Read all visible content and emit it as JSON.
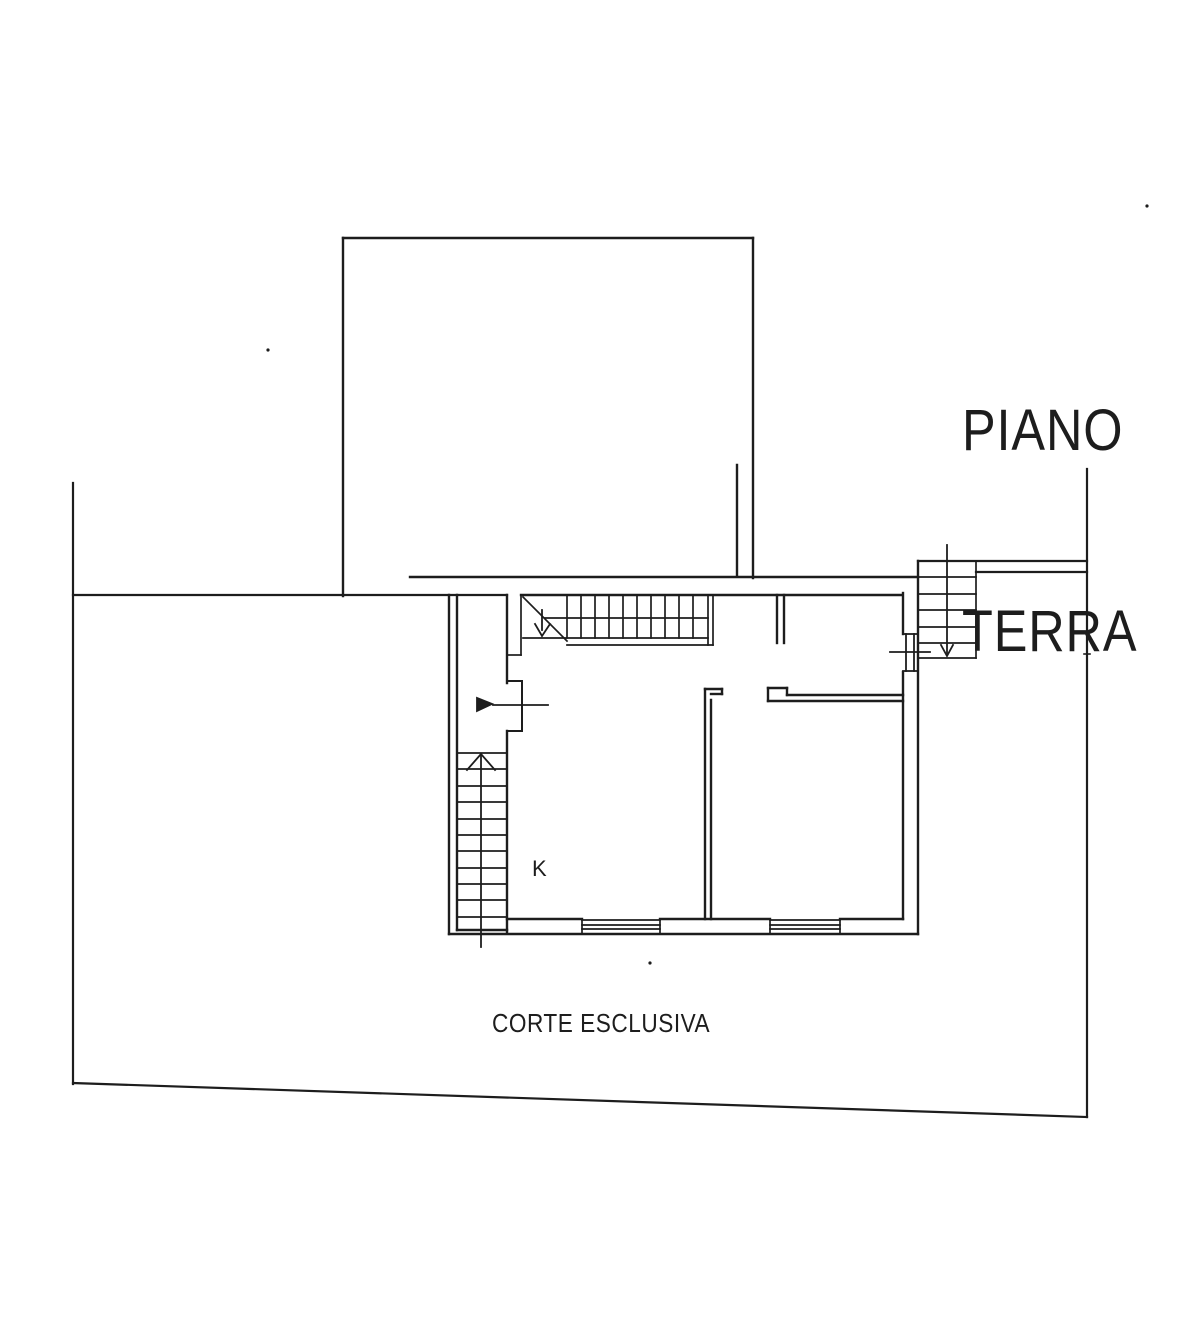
{
  "page": {
    "width": 1204,
    "height": 1328,
    "background": "#ffffff",
    "ink": "#1d1d1d"
  },
  "title": {
    "line1": "PIANO",
    "line2": "TERRA"
  },
  "plan_labels": {
    "kitchen": "K",
    "courtyard": "CORTE ESCLUSIVA"
  },
  "drawing": {
    "groups": [
      {
        "name": "property-boundary",
        "stroke_width": 2.2,
        "lines": [
          [
            73,
            483,
            73,
            1084
          ],
          [
            73,
            1083,
            1087,
            1117
          ],
          [
            1087,
            469,
            1087,
            1117
          ],
          [
            73,
            595,
            507,
            595
          ],
          [
            918,
            561,
            1087,
            561
          ],
          [
            976,
            572,
            1087,
            572
          ]
        ]
      },
      {
        "name": "upper-building",
        "stroke_width": 2.4,
        "lines": [
          [
            343,
            238,
            343,
            596
          ],
          [
            343,
            238,
            753,
            238
          ],
          [
            753,
            238,
            753,
            578
          ],
          [
            410,
            577,
            918,
            577
          ],
          [
            737,
            465,
            737,
            576
          ]
        ]
      },
      {
        "name": "main-building-walls",
        "stroke_width": 2.4,
        "lines": [
          [
            449,
            595,
            449,
            934
          ],
          [
            457,
            595,
            457,
            930
          ],
          [
            521,
            595,
            902,
            595
          ],
          [
            507,
            595,
            507,
            683
          ],
          [
            507,
            731,
            507,
            933
          ],
          [
            449,
            934,
            918,
            934
          ],
          [
            457,
            930,
            507,
            930
          ],
          [
            507,
            919,
            582,
            919
          ],
          [
            660,
            919,
            770,
            919
          ],
          [
            840,
            919,
            903,
            919
          ],
          [
            903,
            593,
            903,
            634
          ],
          [
            903,
            672,
            903,
            919
          ],
          [
            918,
            561,
            918,
            934
          ],
          [
            705,
            689,
            705,
            919
          ],
          [
            711,
            700,
            711,
            919
          ],
          [
            705,
            689,
            722,
            689
          ],
          [
            711,
            694,
            722,
            694
          ],
          [
            722,
            689,
            722,
            694
          ],
          [
            768,
            688,
            787,
            688
          ],
          [
            768,
            688,
            768,
            701
          ],
          [
            787,
            688,
            787,
            695
          ],
          [
            787,
            695,
            903,
            695
          ],
          [
            768,
            701,
            903,
            701
          ],
          [
            777,
            595,
            777,
            643
          ],
          [
            784,
            595,
            784,
            643
          ]
        ]
      },
      {
        "name": "entry-door-recess",
        "stroke_width": 2,
        "lines": [
          [
            507,
            681,
            522,
            681
          ],
          [
            507,
            731,
            522,
            731
          ],
          [
            522,
            681,
            522,
            731
          ]
        ]
      },
      {
        "name": "window-symbols",
        "stroke_width": 1.7,
        "lines": [
          [
            582,
            920,
            660,
            920
          ],
          [
            582,
            925,
            660,
            925
          ],
          [
            582,
            929,
            660,
            929
          ],
          [
            582,
            920,
            582,
            933
          ],
          [
            660,
            920,
            660,
            933
          ],
          [
            770,
            920,
            840,
            920
          ],
          [
            770,
            925,
            840,
            925
          ],
          [
            770,
            929,
            840,
            929
          ],
          [
            770,
            920,
            770,
            933
          ],
          [
            840,
            920,
            840,
            933
          ]
        ]
      },
      {
        "name": "entry-door-symbol",
        "stroke_width": 1.8,
        "lines": [
          [
            903,
            634,
            917,
            634
          ],
          [
            903,
            671,
            917,
            671
          ],
          [
            906,
            634,
            906,
            671
          ],
          [
            914,
            634,
            914,
            671
          ],
          [
            890,
            652,
            930,
            652
          ]
        ]
      },
      {
        "name": "stair-top-interior",
        "stroke_width": 1.7,
        "lines": [
          [
            521,
            595,
            521,
            655
          ],
          [
            507,
            655,
            521,
            655
          ],
          [
            523,
            638,
            708,
            638
          ],
          [
            567,
            645,
            713,
            645
          ],
          [
            545,
            618,
            708,
            618
          ],
          [
            708,
            595,
            708,
            645
          ],
          [
            713,
            595,
            713,
            645
          ],
          [
            523,
            597,
            567,
            641
          ],
          [
            567,
            595,
            567,
            638
          ],
          [
            581,
            595,
            581,
            638
          ],
          [
            595,
            595,
            595,
            638
          ],
          [
            609,
            595,
            609,
            638
          ],
          [
            623,
            595,
            623,
            638
          ],
          [
            637,
            595,
            637,
            638
          ],
          [
            651,
            595,
            651,
            638
          ],
          [
            665,
            595,
            665,
            638
          ],
          [
            679,
            595,
            679,
            638
          ],
          [
            693,
            595,
            693,
            638
          ]
        ]
      },
      {
        "name": "stair-left",
        "stroke_width": 1.7,
        "lines": [
          [
            458,
            753,
            506,
            753
          ],
          [
            458,
            769,
            506,
            769
          ],
          [
            458,
            786,
            506,
            786
          ],
          [
            458,
            802,
            506,
            802
          ],
          [
            458,
            819,
            506,
            819
          ],
          [
            458,
            835,
            506,
            835
          ],
          [
            458,
            851,
            506,
            851
          ],
          [
            458,
            868,
            506,
            868
          ],
          [
            458,
            884,
            506,
            884
          ],
          [
            458,
            900,
            506,
            900
          ],
          [
            458,
            917,
            506,
            917
          ]
        ]
      },
      {
        "name": "stair-top-right",
        "stroke_width": 1.7,
        "lines": [
          [
            976,
            561,
            976,
            658
          ],
          [
            918,
            658,
            976,
            658
          ],
          [
            918,
            577,
            976,
            577
          ],
          [
            918,
            594,
            976,
            594
          ],
          [
            918,
            610,
            976,
            610
          ],
          [
            918,
            627,
            976,
            627
          ],
          [
            918,
            643,
            976,
            643
          ]
        ]
      },
      {
        "name": "direction-arrows",
        "stroke_width": 1.8,
        "lines": [
          [
            493,
            705,
            548,
            705
          ],
          [
            481,
            756,
            481,
            947
          ],
          [
            542,
            610,
            542,
            630
          ],
          [
            947,
            545,
            947,
            653
          ]
        ],
        "polylines": [
          [
            467,
            770,
            481,
            754,
            495,
            770
          ],
          [
            535,
            624,
            542,
            636,
            550,
            624
          ],
          [
            941,
            645,
            947,
            656,
            953,
            645
          ]
        ],
        "polygons": [
          [
            477,
            698,
            477,
            711,
            492,
            704
          ]
        ]
      },
      {
        "name": "scan-specks",
        "stroke_width": 1.6,
        "lines": [
          [
            1084,
            654,
            1090,
            654
          ]
        ],
        "dots": [
          [
            268,
            350
          ],
          [
            1147,
            206
          ],
          [
            650,
            963
          ]
        ]
      }
    ]
  }
}
